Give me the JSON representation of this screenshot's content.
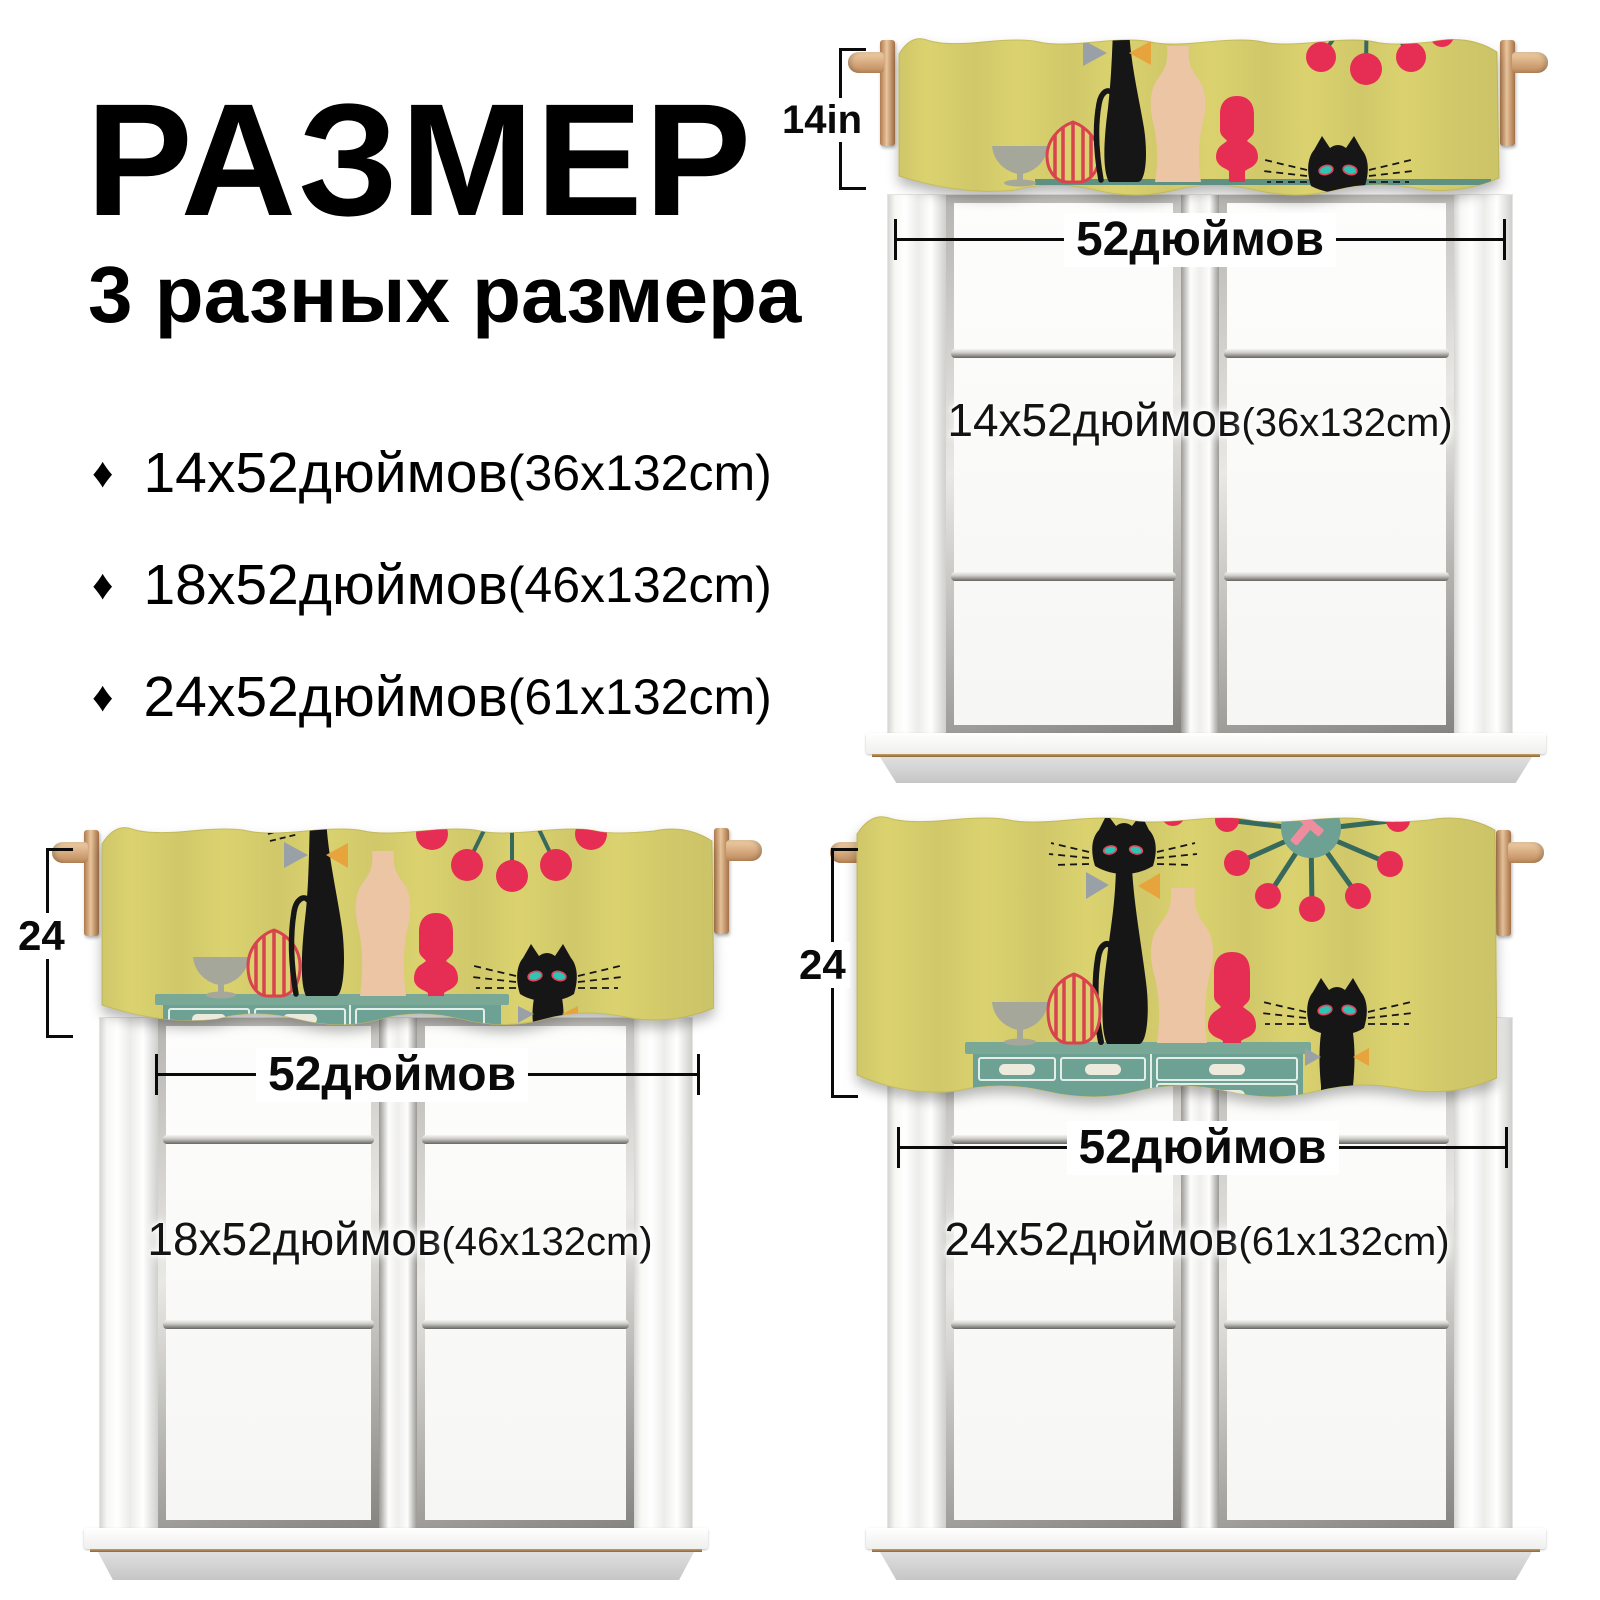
{
  "header": {
    "title": "РАЗМЕР",
    "subtitle": "3 разных размера"
  },
  "icons": {
    "bullet": "♦"
  },
  "sizes_list": {
    "items": [
      {
        "size": "14x52дюймов",
        "metric": "(36x132cm)"
      },
      {
        "size": "18x52дюймов",
        "metric": "(46x132cm)"
      },
      {
        "size": "24x52дюймов",
        "metric": "(61x132cm)"
      }
    ]
  },
  "diagrams": [
    {
      "position": "top-right",
      "height_label": "14in",
      "width_label": "52дюймов",
      "overlay_size": "14x52дюймов",
      "overlay_metric": "(36x132cm)"
    },
    {
      "position": "bottom-left",
      "height_label": "24",
      "width_label": "52дюймов",
      "overlay_size": "18x52дюймов",
      "overlay_metric": "(46x132cm)"
    },
    {
      "position": "bottom-right",
      "height_label": "24",
      "width_label": "52дюймов",
      "overlay_size": "24x52дюймов",
      "overlay_metric": "(61x132cm)"
    }
  ],
  "colors": {
    "valance_yellow": "#dbd26f",
    "print_red": "#e62d53",
    "stripe_red": "#d8434e",
    "credenza_teal": "#6ca193",
    "stem_teal": "#37695c",
    "peach": "#ecc5a5",
    "goblet_gray": "#a4a79a",
    "cat_black": "#161616",
    "eye_teal": "#2ec4b6",
    "wood_tan": "#d9a97e",
    "dimension_black": "#0a0a0a"
  }
}
